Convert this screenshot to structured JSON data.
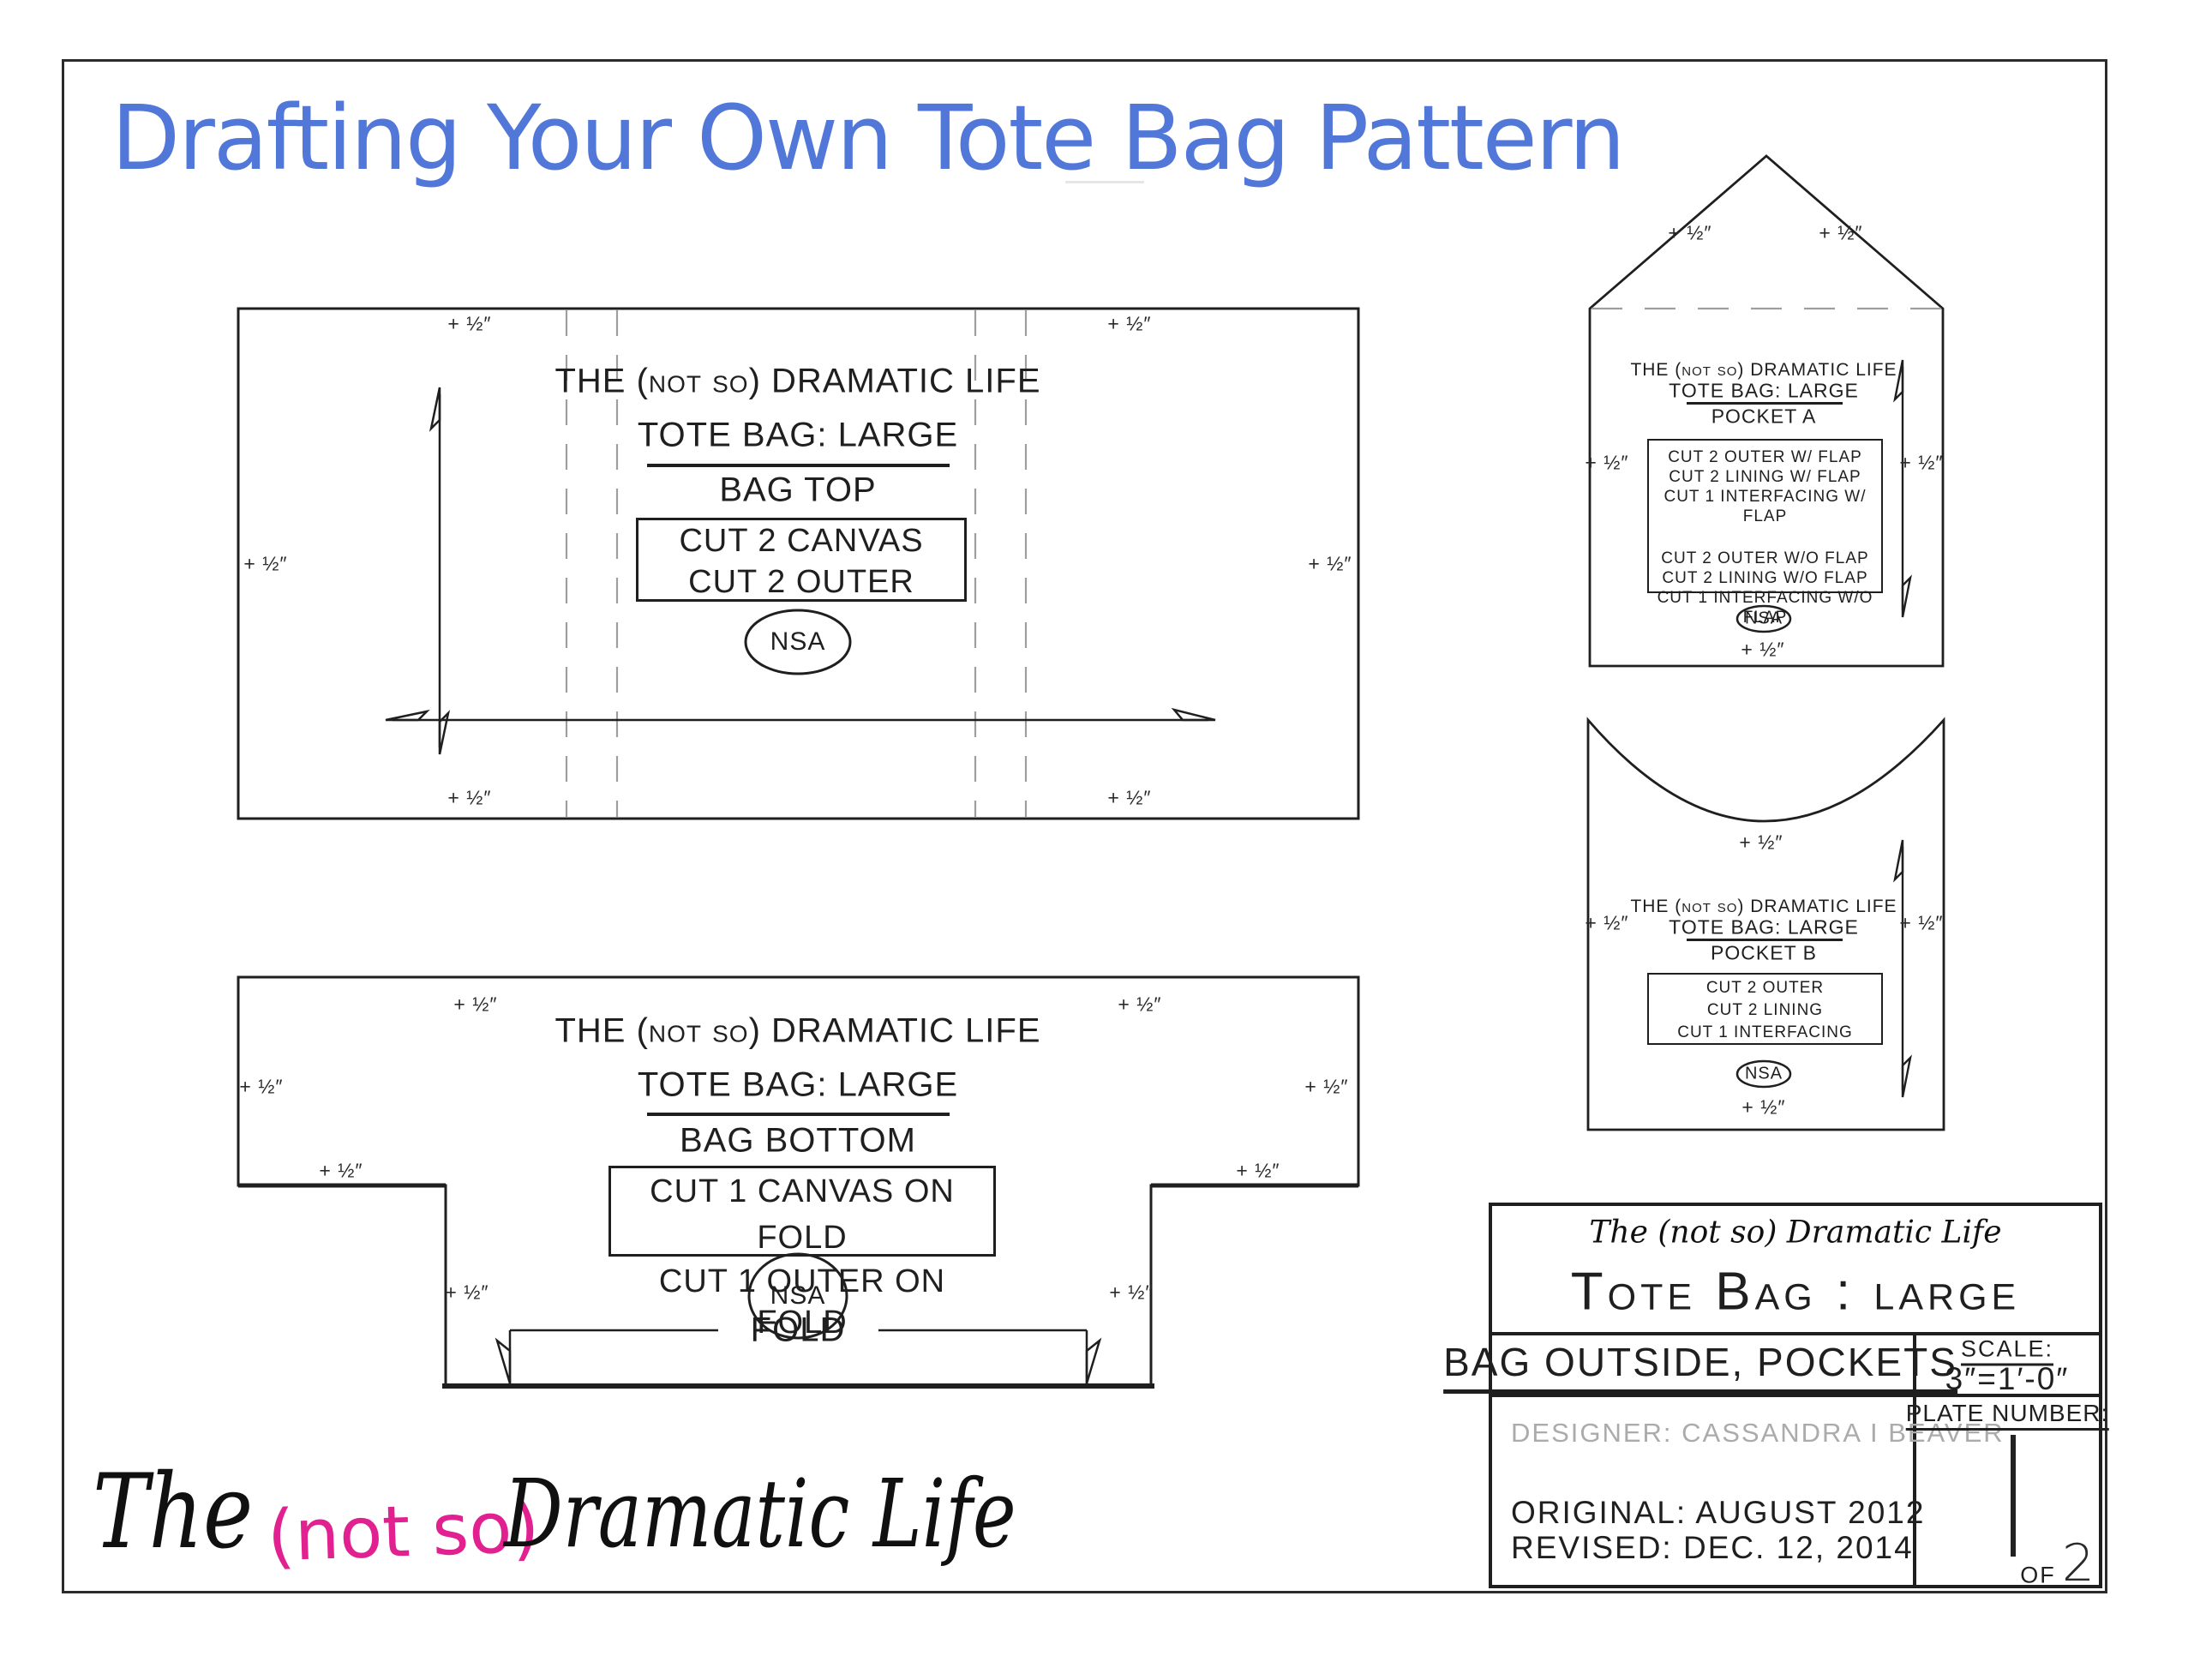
{
  "page_title": {
    "text": "Drafting Your Own Tote Bag Pattern"
  },
  "colors": {
    "title_blue": "#5177d9",
    "logo_pink": "#e0218f",
    "line_black": "#1f1f1f",
    "dash_gray": "#9e9e9e",
    "designer_gray": "#ababab"
  },
  "seam_allowance": {
    "label": "+ ½″"
  },
  "piece_common": {
    "brand": "THE (not so) DRAMATIC LIFE",
    "product": "TOTE BAG: LARGE",
    "nsa": "NSA"
  },
  "pieces": {
    "bag_top": {
      "name": "BAG TOP",
      "cut_lines": [
        "CUT 2 CANVAS",
        "CUT 2 OUTER"
      ]
    },
    "bag_bottom": {
      "name": "BAG BOTTOM",
      "cut_lines": [
        "CUT 1 CANVAS ON FOLD",
        "CUT 1 OUTER ON FOLD"
      ],
      "fold_label": "FOLD"
    },
    "pocket_a": {
      "name": "POCKET A",
      "cut_lines": [
        "CUT 2 OUTER W/ FLAP",
        "CUT 2 LINING W/ FLAP",
        "CUT 1 INTERFACING W/ FLAP",
        "CUT 2 OUTER W/O FLAP",
        "CUT 2 LINING W/O FLAP",
        "CUT 1 INTERFACING W/O FLAP"
      ]
    },
    "pocket_b": {
      "name": "POCKET B",
      "cut_lines": [
        "CUT 2 OUTER",
        "CUT 2 LINING",
        "CUT 1 INTERFACING"
      ]
    }
  },
  "title_block": {
    "brand_script": "The (not so) Dramatic Life",
    "product": "Tote Bag : large",
    "sheet_name": "BAG OUTSIDE, POCKETS",
    "scale_label": "SCALE:",
    "scale_value": "3″=1′-0″",
    "designer": "DESIGNER:  CASSANDRA I BEAVER",
    "original": "ORIGINAL:  AUGUST 2012",
    "revised": "REVISED:  DEC. 12, 2014",
    "plate_label": "PLATE NUMBER:",
    "plate_number": "1",
    "of_label": "OF",
    "plate_total": "2"
  },
  "logo": {
    "part1": "The",
    "part2": "(not so)",
    "part3": "Dramatic Life"
  }
}
